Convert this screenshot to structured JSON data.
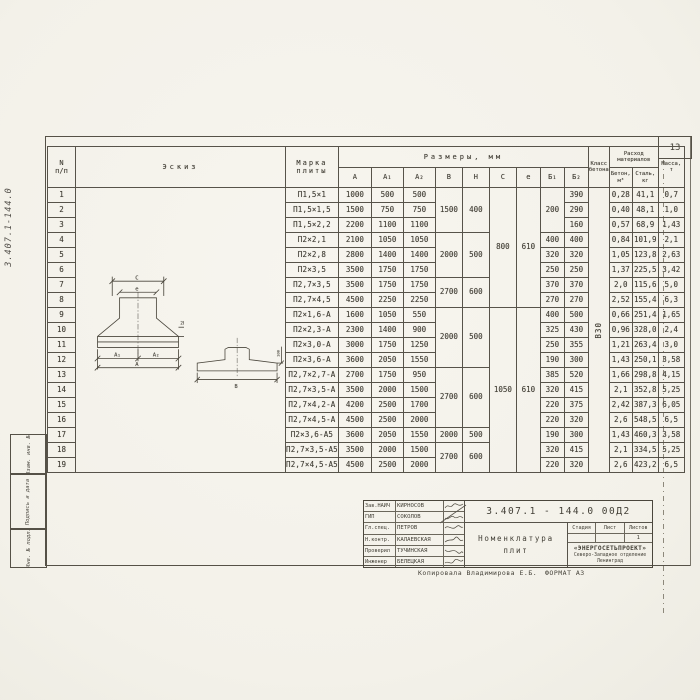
{
  "page": {
    "sheet_number": "13",
    "doc_number_vertical": "3.407.1-144.0",
    "copy_note": "Копировала  Владимирова Е.Б.",
    "format_note": "ФОРМАТ А3"
  },
  "side_stamps": {
    "stamp1": "Взам. инв. №",
    "stamp2": "Подпись и дата",
    "stamp3": "Инв. № подл."
  },
  "table": {
    "headers": {
      "num": "N\nп/п",
      "sketch": "Эскиз",
      "mark": "Марка\nплиты",
      "dims": "Размеры,  мм",
      "dim_cols": [
        "А",
        "А₁",
        "А₂",
        "В",
        "Н",
        "С",
        "е",
        "Б₁",
        "Б₂"
      ],
      "concrete_class": "Класс\nбетона",
      "consumption": "Расход\nматериалов",
      "concrete": "Бетон,\nм³",
      "steel": "Сталь,\nкг",
      "mass": "Масса,\nт"
    },
    "concrete_class_value": "В30",
    "rows": [
      {
        "n": "1",
        "mark": "П1,5×1",
        "a": "1000",
        "a1": "500",
        "a2": "500",
        "b1": "",
        "b2": "390",
        "conc": "0,28",
        "steel": "41,1",
        "mass": "0,7"
      },
      {
        "n": "2",
        "mark": "П1,5×1,5",
        "a": "1500",
        "a1": "750",
        "a2": "750",
        "b1": "",
        "b2": "290",
        "conc": "0,40",
        "steel": "48,1",
        "mass": "1,0"
      },
      {
        "n": "3",
        "mark": "П1,5×2,2",
        "a": "2200",
        "a1": "1100",
        "a2": "1100",
        "b1": "",
        "b2": "160",
        "conc": "0,57",
        "steel": "68,9",
        "mass": "1,43"
      },
      {
        "n": "4",
        "mark": "П2×2,1",
        "a": "2100",
        "a1": "1050",
        "a2": "1050",
        "b1": "400",
        "b2": "400",
        "conc": "0,84",
        "steel": "101,9",
        "mass": "2,1"
      },
      {
        "n": "5",
        "mark": "П2×2,8",
        "a": "2800",
        "a1": "1400",
        "a2": "1400",
        "b1": "320",
        "b2": "320",
        "conc": "1,05",
        "steel": "123,8",
        "mass": "2,63"
      },
      {
        "n": "6",
        "mark": "П2×3,5",
        "a": "3500",
        "a1": "1750",
        "a2": "1750",
        "b1": "250",
        "b2": "250",
        "conc": "1,37",
        "steel": "225,5",
        "mass": "3,42"
      },
      {
        "n": "7",
        "mark": "П2,7×3,5",
        "a": "3500",
        "a1": "1750",
        "a2": "1750",
        "b1": "370",
        "b2": "370",
        "conc": "2,0",
        "steel": "115,6",
        "mass": "5,0"
      },
      {
        "n": "8",
        "mark": "П2,7×4,5",
        "a": "4500",
        "a1": "2250",
        "a2": "2250",
        "b1": "270",
        "b2": "270",
        "conc": "2,52",
        "steel": "155,4",
        "mass": "6,3"
      },
      {
        "n": "9",
        "mark": "П2×1,6-А",
        "a": "1600",
        "a1": "1050",
        "a2": "550",
        "b1": "400",
        "b2": "500",
        "conc": "0,66",
        "steel": "251,4",
        "mass": "1,65"
      },
      {
        "n": "10",
        "mark": "П2×2,3-А",
        "a": "2300",
        "a1": "1400",
        "a2": "900",
        "b1": "325",
        "b2": "430",
        "conc": "0,96",
        "steel": "328,0",
        "mass": "2,4"
      },
      {
        "n": "11",
        "mark": "П2×3,0-А",
        "a": "3000",
        "a1": "1750",
        "a2": "1250",
        "b1": "250",
        "b2": "355",
        "conc": "1,21",
        "steel": "263,4",
        "mass": "3,0"
      },
      {
        "n": "12",
        "mark": "П2×3,6-А",
        "a": "3600",
        "a1": "2050",
        "a2": "1550",
        "b1": "190",
        "b2": "300",
        "conc": "1,43",
        "steel": "250,1",
        "mass": "3,58"
      },
      {
        "n": "13",
        "mark": "П2,7×2,7-А",
        "a": "2700",
        "a1": "1750",
        "a2": "950",
        "b1": "385",
        "b2": "520",
        "conc": "1,66",
        "steel": "298,8",
        "mass": "4,15"
      },
      {
        "n": "14",
        "mark": "П2,7×3,5-А",
        "a": "3500",
        "a1": "2000",
        "a2": "1500",
        "b1": "320",
        "b2": "415",
        "conc": "2,1",
        "steel": "352,8",
        "mass": "5,25"
      },
      {
        "n": "15",
        "mark": "П2,7×4,2-А",
        "a": "4200",
        "a1": "2500",
        "a2": "1700",
        "b1": "220",
        "b2": "375",
        "conc": "2,42",
        "steel": "387,3",
        "mass": "6,05"
      },
      {
        "n": "16",
        "mark": "П2,7×4,5-А",
        "a": "4500",
        "a1": "2500",
        "a2": "2000",
        "b1": "220",
        "b2": "320",
        "conc": "2,6",
        "steel": "548,5",
        "mass": "6,5"
      },
      {
        "n": "17",
        "mark": "П2×3,6-А5",
        "a": "3600",
        "a1": "2050",
        "a2": "1550",
        "b1": "190",
        "b2": "300",
        "conc": "1,43",
        "steel": "460,3",
        "mass": "3,58"
      },
      {
        "n": "18",
        "mark": "П2,7×3,5-А5",
        "a": "3500",
        "a1": "2000",
        "a2": "1500",
        "b1": "320",
        "b2": "415",
        "conc": "2,1",
        "steel": "334,5",
        "mass": "5,25"
      },
      {
        "n": "19",
        "mark": "П2,7×4,5-А5",
        "a": "4500",
        "a1": "2500",
        "a2": "2000",
        "b1": "220",
        "b2": "320",
        "conc": "2,6",
        "steel": "423,2",
        "mass": "6,5"
      }
    ],
    "merges": {
      "bh": [
        {
          "start": 1,
          "span": 3,
          "b": "1500",
          "h": "400"
        },
        {
          "start": 4,
          "span": 3,
          "b": "2000",
          "h": "500"
        },
        {
          "start": 7,
          "span": 2,
          "b": "2700",
          "h": "600"
        },
        {
          "start": 9,
          "span": 4,
          "b": "2000",
          "h": "500"
        },
        {
          "start": 13,
          "span": 4,
          "b": "2700",
          "h": "600"
        },
        {
          "start": 17,
          "span": 1,
          "b": "2000",
          "h": "500"
        },
        {
          "start": 18,
          "span": 2,
          "b": "2700",
          "h": "600"
        }
      ],
      "ce": [
        {
          "start": 1,
          "span": 8,
          "c": "800",
          "e": "610"
        },
        {
          "start": 9,
          "span": 11,
          "c": "1050",
          "e": "610"
        }
      ],
      "b1": [
        {
          "start": 1,
          "span": 3,
          "v": "200"
        }
      ]
    }
  },
  "sketch": {
    "dim_c": "С",
    "dim_e": "е",
    "dim_a1": "А₁",
    "dim_a2": "А₂",
    "dim_a": "А",
    "dim_b": "В",
    "dim_100": "100",
    "dim_20": "20"
  },
  "title_block": {
    "doc_number": "3.407.1 - 144.0   00Д2",
    "title": "Номенклатура\nплит",
    "signers": [
      {
        "role": "Зав.НАИЧ",
        "name": "Кирносов"
      },
      {
        "role": "ГИП",
        "name": "Соколов"
      },
      {
        "role": "Гл.спец.",
        "name": "Петров"
      },
      {
        "role": "Н.контр.",
        "name": "Калаевская"
      },
      {
        "role": "Проверил",
        "name": "Тучинская"
      },
      {
        "role": "Инженер",
        "name": "Белецкая"
      }
    ],
    "stage_label": "Стадия",
    "sheet_label": "Лист",
    "sheets_label": "Листов",
    "sheets_value": "1",
    "org_name": "«ЭНЕРГОСЕТЬПРОЕКТ»",
    "org_branch": "Северо-Западное отделение",
    "org_city": "Ленинград"
  }
}
